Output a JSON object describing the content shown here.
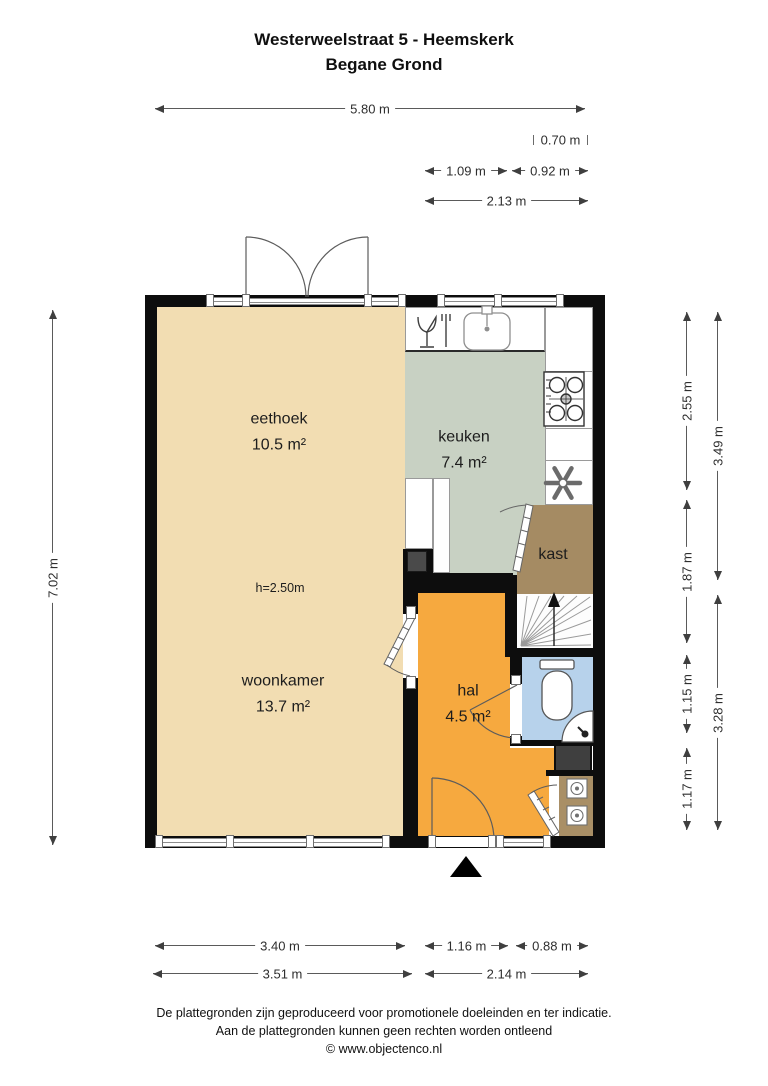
{
  "title": {
    "line1": "Westerweelstraat 5 - Heemskerk",
    "line2": "Begane Grond"
  },
  "rooms": [
    {
      "name": "eethoek",
      "area": "10.5 m²"
    },
    {
      "name": "keuken",
      "area": "7.4 m²"
    },
    {
      "name": "kast",
      "area": ""
    },
    {
      "name": "woonkamer",
      "area": "13.7 m²"
    },
    {
      "name": "hal",
      "area": "4.5 m²"
    }
  ],
  "ceiling_height_note": "h=2.50m",
  "dimensions": {
    "top": [
      "5.80 m",
      "0.70 m",
      "1.09 m",
      "0.92 m",
      "2.13 m"
    ],
    "left": [
      "7.02 m"
    ],
    "right_inner": [
      "2.55 m",
      "1.87 m",
      "1.15 m",
      "1.17 m"
    ],
    "right_outer": [
      "3.49 m",
      "3.28 m"
    ],
    "bottom_upper": [
      "3.40 m",
      "1.16 m",
      "0.88 m"
    ],
    "bottom_lower": [
      "3.51 m",
      "2.14 m"
    ]
  },
  "footer": {
    "line1": "De plattegronden zijn geproduceerd voor promotionele doeleinden en ter indicatie.",
    "line2": "Aan de plattegronden kunnen geen rechten worden ontleend",
    "line3": "© www.objectenco.nl"
  },
  "colors": {
    "living": "#f2ddb2",
    "kitchen": "#c8d1c3",
    "closet": "#a58b63",
    "storage": "#a98f66",
    "hall": "#f6a93f",
    "toilet": "#b7d2eb",
    "duct": "#3f3f3f",
    "wall": "#0d0d0d"
  }
}
